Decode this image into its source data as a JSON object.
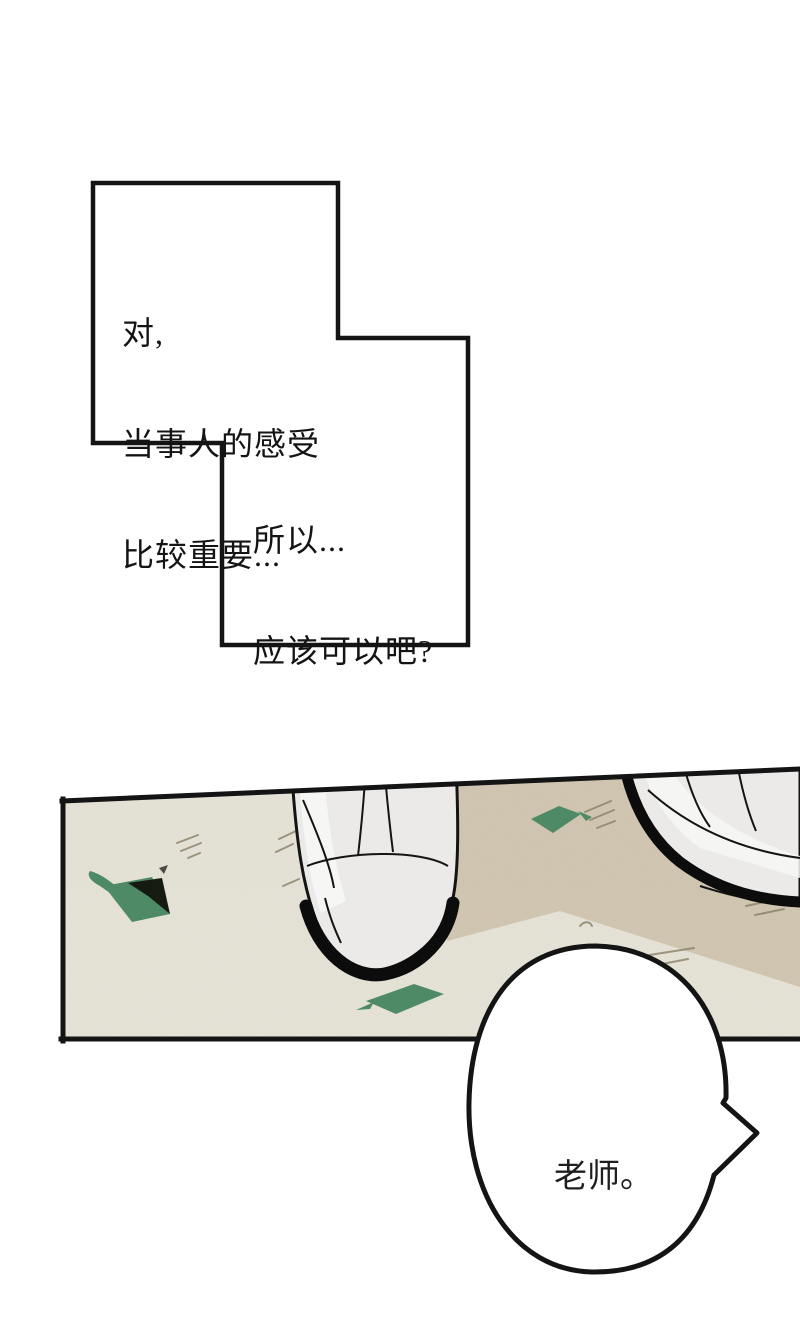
{
  "comic": {
    "bubble1": {
      "line1": "对,",
      "line2": "当事人的感受",
      "line3": "比较重要..."
    },
    "bubble2": {
      "line1": "所以...",
      "line2": "应该可以吧?"
    },
    "bubble3": {
      "text": "老师。"
    }
  },
  "colors": {
    "background": "#ffffff",
    "ink": "#141414",
    "bubble_fill": "#ffffff",
    "floor_light": "#e7e4d9",
    "floor_tan": "#d2c7b2",
    "leaf_green": "#4e8a66",
    "leaf_shadow": "#161b12",
    "shoe_white": "#ebeae8",
    "shoe_highlight": "#f7f7f5",
    "sole_black": "#0c0c0c",
    "scratch": "#8a8068"
  }
}
